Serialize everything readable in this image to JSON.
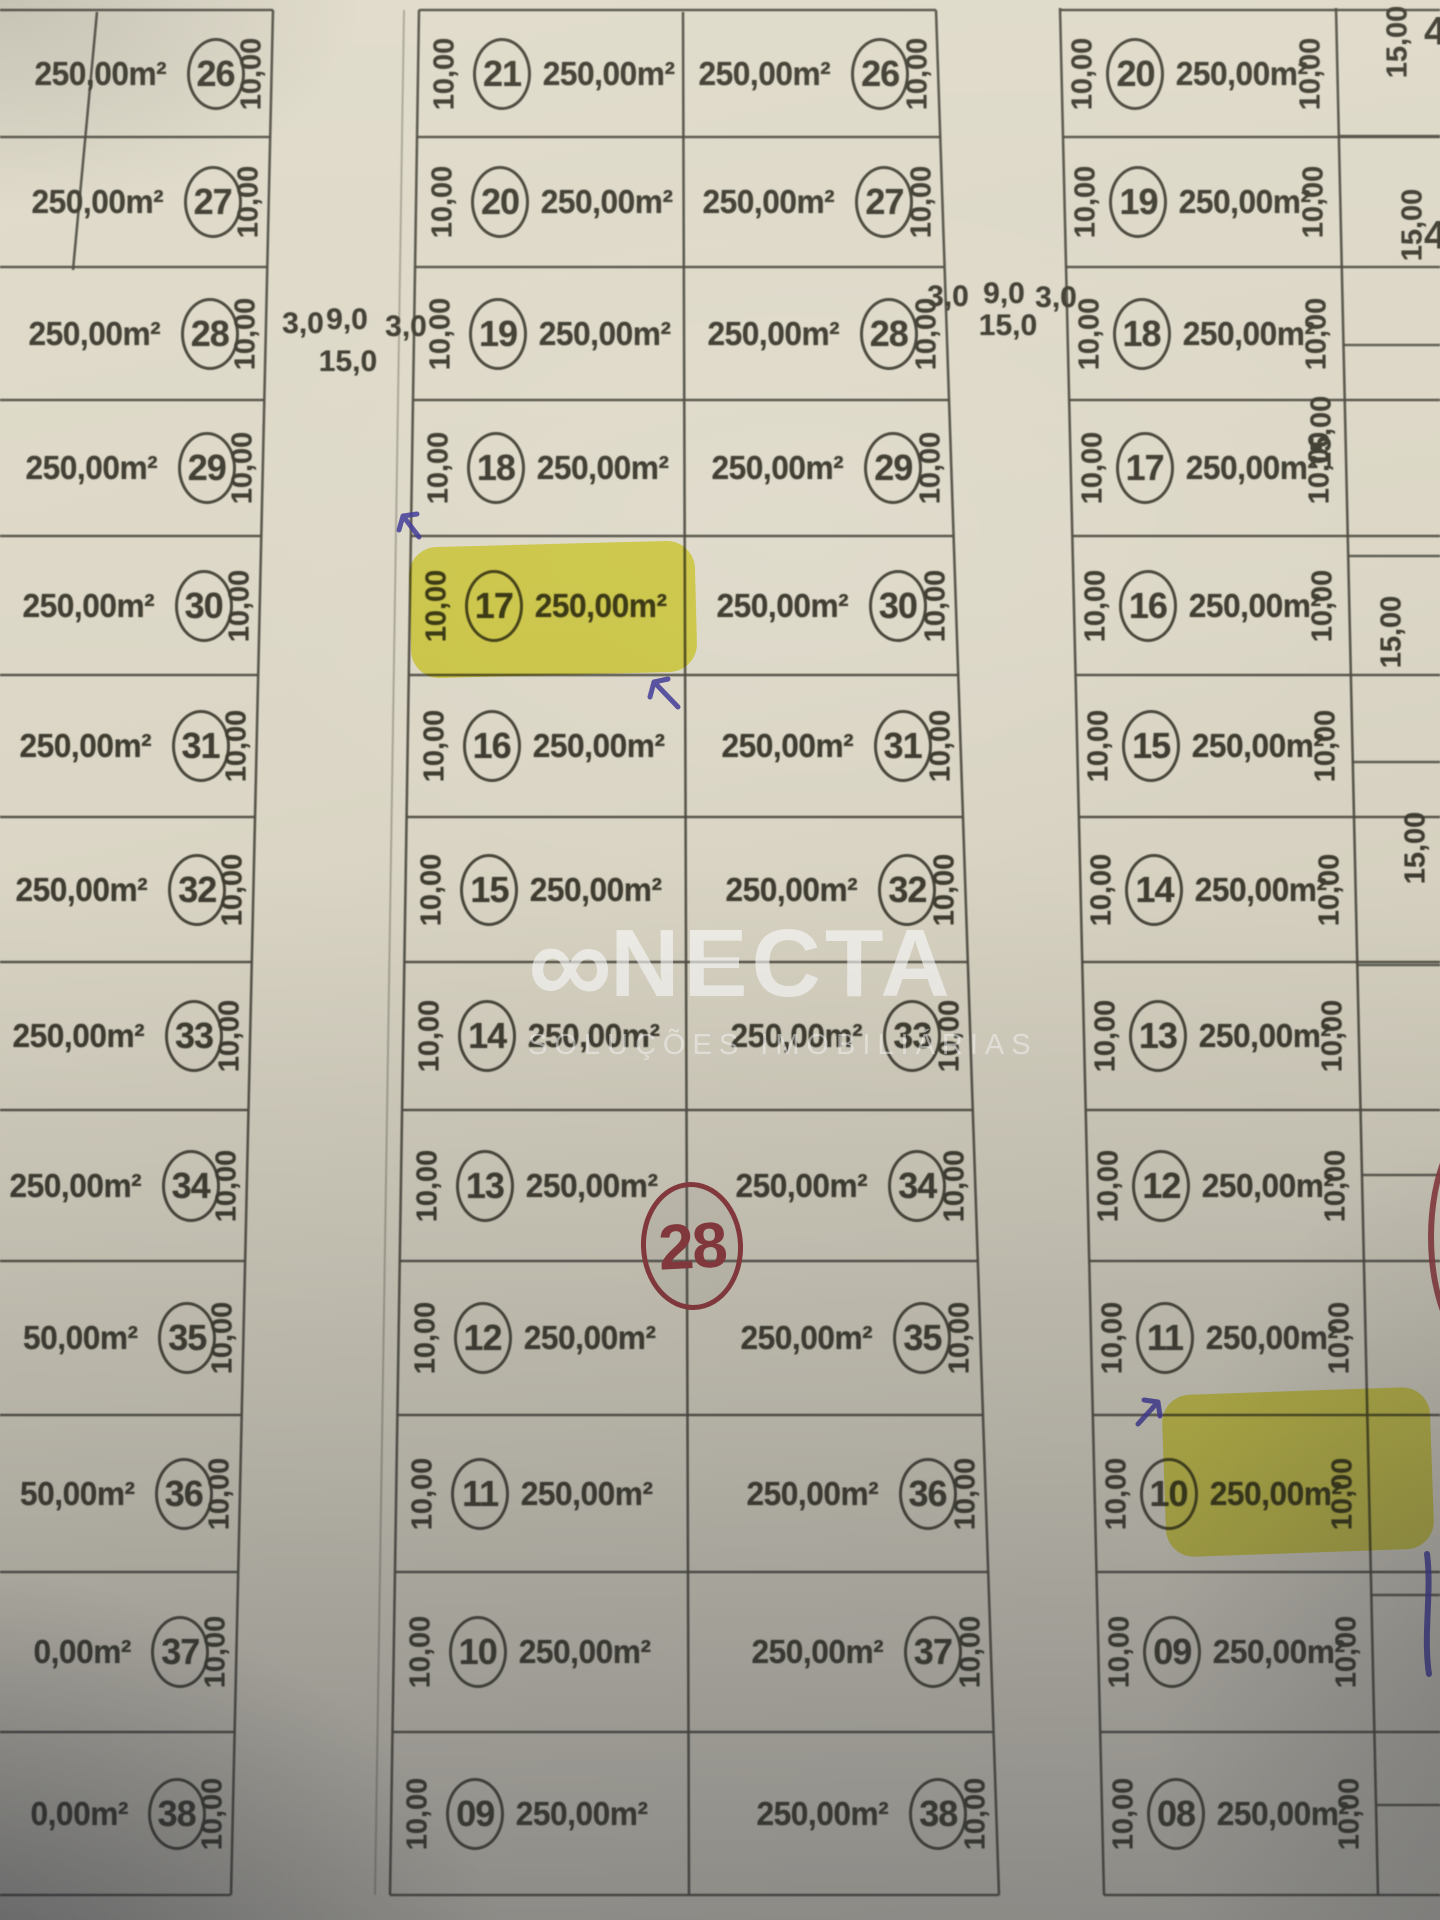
{
  "watermark": {
    "brand": "CONECTA",
    "brand_display": {
      "logo_glyph": "∞",
      "rest": "NECTA"
    },
    "subtitle": "SOLUÇÕES IMOBILIÁRIAS"
  },
  "quadra": {
    "middle_number": "28"
  },
  "streets": {
    "left": {
      "sidewalk_left": "3,0",
      "road_width": "9,0",
      "total_width": "15,0",
      "sidewalk_right": "3,0"
    },
    "right": {
      "sidewalk_left": "3,0",
      "road_width": "9,0",
      "total_width": "15,0",
      "sidewalk_right": "3,0"
    }
  },
  "left_block": {
    "rows": [
      {
        "area": "250,00m²",
        "num": "26",
        "dim": "10,00"
      },
      {
        "area": "250,00m²",
        "num": "27",
        "dim": "10,00"
      },
      {
        "area": "250,00m²",
        "num": "28",
        "dim": "10,00"
      },
      {
        "area": "250,00m²",
        "num": "29",
        "dim": "10,00"
      },
      {
        "area": "250,00m²",
        "num": "30",
        "dim": "10,00"
      },
      {
        "area": "250,00m²",
        "num": "31",
        "dim": "10,00"
      },
      {
        "area": "250,00m²",
        "num": "32",
        "dim": "10,00"
      },
      {
        "area": "250,00m²",
        "num": "33",
        "dim": "10,00"
      },
      {
        "area": "250,00m²",
        "num": "34",
        "dim": "10,00"
      },
      {
        "area": "50,00m²",
        "num": "35",
        "dim": "10,00"
      },
      {
        "area": "50,00m²",
        "num": "36",
        "dim": "10,00"
      },
      {
        "area": "0,00m²",
        "num": "37",
        "dim": "10,00"
      },
      {
        "area": "0,00m²",
        "num": "38",
        "dim": "10,00"
      }
    ]
  },
  "middle_block": {
    "left_rows": [
      {
        "dim": "10,00",
        "num": "21",
        "area": "250,00m²"
      },
      {
        "dim": "10,00",
        "num": "20",
        "area": "250,00m²"
      },
      {
        "dim": "10,00",
        "num": "19",
        "area": "250,00m²"
      },
      {
        "dim": "10,00",
        "num": "18",
        "area": "250,00m²"
      },
      {
        "dim": "10,00",
        "num": "17",
        "area": "250,00m²",
        "highlight": true
      },
      {
        "dim": "10,00",
        "num": "16",
        "area": "250,00m²"
      },
      {
        "dim": "10,00",
        "num": "15",
        "area": "250,00m²"
      },
      {
        "dim": "10,00",
        "num": "14",
        "area": "250,00m²"
      },
      {
        "dim": "10,00",
        "num": "13",
        "area": "250,00m²"
      },
      {
        "dim": "10,00",
        "num": "12",
        "area": "250,00m²"
      },
      {
        "dim": "10,00",
        "num": "11",
        "area": "250,00m²"
      },
      {
        "dim": "10,00",
        "num": "10",
        "area": "250,00m²"
      },
      {
        "dim": "10,00",
        "num": "09",
        "area": "250,00m²"
      }
    ],
    "right_rows": [
      {
        "area": "250,00m²",
        "num": "26",
        "dim": "10,00"
      },
      {
        "area": "250,00m²",
        "num": "27",
        "dim": "10,00"
      },
      {
        "area": "250,00m²",
        "num": "28",
        "dim": "10,00"
      },
      {
        "area": "250,00m²",
        "num": "29",
        "dim": "10,00"
      },
      {
        "area": "250,00m²",
        "num": "30",
        "dim": "10,00"
      },
      {
        "area": "250,00m²",
        "num": "31",
        "dim": "10,00"
      },
      {
        "area": "250,00m²",
        "num": "32",
        "dim": "10,00"
      },
      {
        "area": "250,00m²",
        "num": "33",
        "dim": "10,00"
      },
      {
        "area": "250,00m²",
        "num": "34",
        "dim": "10,00"
      },
      {
        "area": "250,00m²",
        "num": "35",
        "dim": "10,00"
      },
      {
        "area": "250,00m²",
        "num": "36",
        "dim": "10,00"
      },
      {
        "area": "250,00m²",
        "num": "37",
        "dim": "10,00"
      },
      {
        "area": "250,00m²",
        "num": "38",
        "dim": "10,00"
      }
    ]
  },
  "right_block": {
    "rows": [
      {
        "dim_left": "10,00",
        "num": "20",
        "area": "250,00m²",
        "dim_right": "10,00"
      },
      {
        "dim_left": "10,00",
        "num": "19",
        "area": "250,00m²",
        "dim_right": "10,00"
      },
      {
        "dim_left": "10,00",
        "num": "18",
        "area": "250,00m²",
        "dim_right": "10,00"
      },
      {
        "dim_left": "10,00",
        "num": "17",
        "area": "250,00m²",
        "dim_right": "10,00"
      },
      {
        "dim_left": "10,00",
        "num": "16",
        "area": "250,00m²",
        "dim_right": "10,00"
      },
      {
        "dim_left": "10,00",
        "num": "15",
        "area": "250,00m²",
        "dim_right": "10,00"
      },
      {
        "dim_left": "10,00",
        "num": "14",
        "area": "250,00m²",
        "dim_right": "10,00"
      },
      {
        "dim_left": "10,00",
        "num": "13",
        "area": "250,00m²",
        "dim_right": "10,00"
      },
      {
        "dim_left": "10,00",
        "num": "12",
        "area": "250,00m²",
        "dim_right": "10,00"
      },
      {
        "dim_left": "10,00",
        "num": "11",
        "area": "250,00m²",
        "dim_right": "10,00"
      },
      {
        "dim_left": "10,00",
        "num": "10",
        "area": "250,00m²",
        "dim_right": "10,00",
        "highlight": true
      },
      {
        "dim_left": "10,00",
        "num": "09",
        "area": "250,00m²",
        "dim_right": "10,00"
      },
      {
        "dim_left": "10,00",
        "num": "08",
        "area": "250,00m²",
        "dim_right": "10,00"
      }
    ],
    "east_column": {
      "width_labels": [
        "15,00",
        "15,00",
        "15,00",
        "15,00",
        "15,00"
      ],
      "partial_lot_digits": [
        "4",
        "4"
      ]
    }
  },
  "highlights": {
    "middle_lot": "17",
    "right_lot": "10"
  }
}
